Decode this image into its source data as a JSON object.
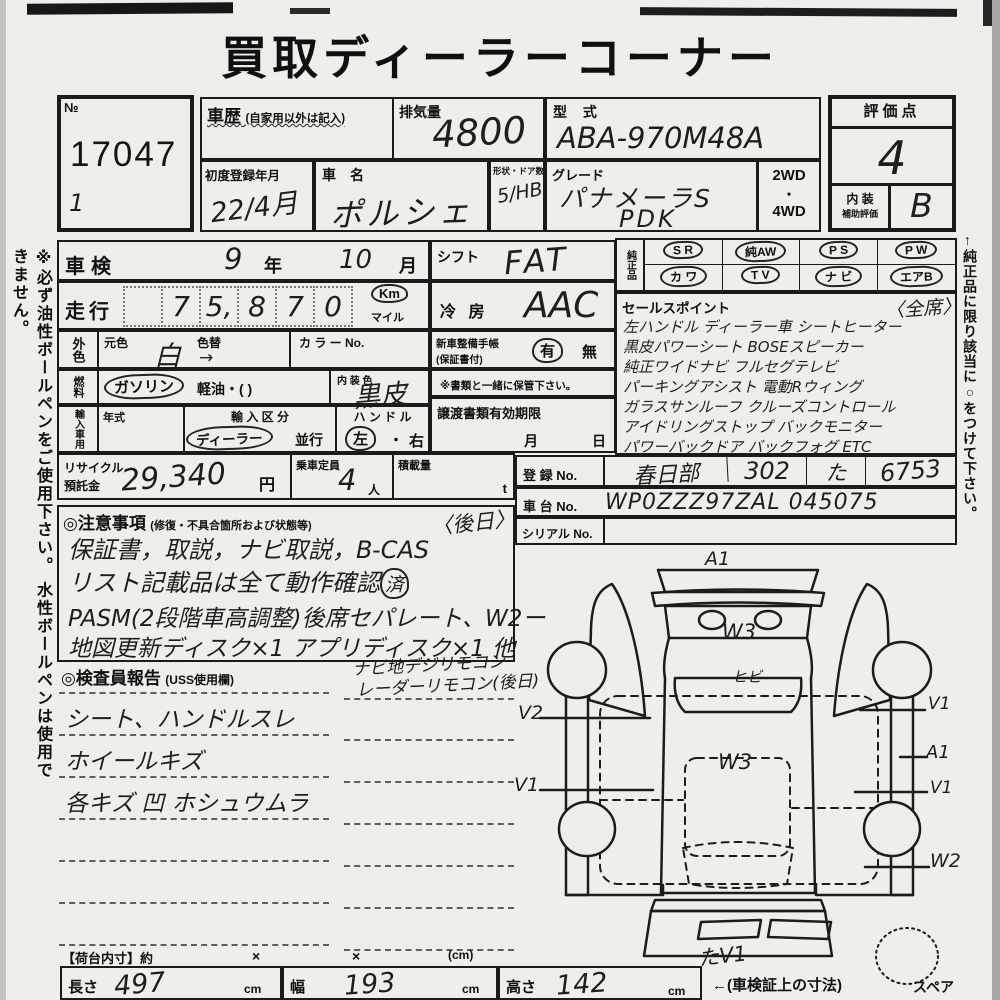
{
  "page": {
    "title": "買取ディーラーコーナー",
    "left_note": "※必ず油性ボールペンをご使用下さい。 水性ボールペンは使用できません。",
    "right_note": "←純正品に限り該当に○をつけて下さい。"
  },
  "header": {
    "no_label": "№",
    "no_value": "17047",
    "no_sub": "1",
    "shareki_label": "車歴",
    "shareki_note": "(自家用以外は記入)",
    "haikiryo_label": "排気量",
    "haikiryo_value": "4800",
    "katashiki_label": "型 式",
    "katashiki_value": "ABA-970M48A",
    "hyokaten_label": "評価点",
    "hyokaten_value": "4",
    "naiso_label_1": "内 装",
    "naiso_label_2": "補助評価",
    "naiso_value": "B",
    "shodo_label": "初度登録年月",
    "shodo_value": "22/4月",
    "shamei_label": "車　名",
    "shamei_value": "ポルシェ",
    "keijo_label": "形状・ドア数",
    "keijo_value": "5/HB",
    "grade_label": "グレード",
    "grade_value_1": "パナメーラS",
    "grade_value_2": "PDK",
    "drive": [
      "2WD",
      "・",
      "4WD"
    ]
  },
  "main": {
    "shaken_label": "車検",
    "shaken_year": "9",
    "shaken_year_unit": "年",
    "shaken_month": "10",
    "shaken_month_unit": "月",
    "soko_label": "走行",
    "soko_digits": [
      "",
      "7",
      "5,",
      "8",
      "7",
      "0"
    ],
    "soko_km": "Km",
    "soko_mile": "マイル",
    "shift_label": "シフト",
    "shift_value": "FAT",
    "reibo_label": "冷 房",
    "reibo_value": "AAC",
    "gaishoku_label": "外色",
    "motoiro_label": "元色",
    "motoiro_value": "白",
    "motoiro_arrow": "→",
    "irogae_label": "色替",
    "color_no_label": "カ ラ ー No.",
    "seibi_label_1": "新車整備手帳",
    "seibi_label_2": "(保証書付)",
    "seibi_yes": "有",
    "seibi_no": "無",
    "hokan_note": "※書類と一緒に保管下さい。",
    "nenryo_label": "燃料",
    "nenryo_gasoline": "ガソリン",
    "nenryo_keiyu": "軽油・(          )",
    "naisoshoku_label": "内 装 色",
    "naisoshoku_value": "黒皮",
    "yunyu_label": "輸入車用",
    "nenshiki_label": "年式",
    "kubun_label": "輸 入 区 分",
    "kubun_dealer": "ディーラー",
    "kubun_heiko": "並行",
    "handle_label": "ハ ン ド ル",
    "handle_left": "左",
    "handle_dot": "・",
    "handle_right": "右",
    "joto_label": "譲渡書類有効期限",
    "joto_month": "月",
    "joto_day": "日",
    "recycle_label_1": "リサイクル",
    "recycle_label_2": "預託金",
    "recycle_value": "29,340",
    "recycle_unit": "円",
    "teiin_label": "乗車定員",
    "teiin_value": "4",
    "teiin_unit": "人",
    "sekisai_label": "積載量",
    "sekisai_unit": "t"
  },
  "junseihin": {
    "label": "純正品",
    "items": [
      "S R",
      "純AW",
      "P S",
      "P W",
      "カ ワ",
      "T V",
      "ナ ビ",
      "エアB"
    ]
  },
  "sales": {
    "label": "セールスポイント",
    "zenseki": "〈全席〉",
    "lines": [
      "左ハンドル ディーラー車 シートヒーター",
      "黒皮パワーシート BOSEスピーカー",
      "純正ワイドナビ フルセグテレビ",
      "パーキングアシスト 電動Rウィング",
      "ガラスサンルーフ クルーズコントロール",
      "アイドリングストップ バックモニター",
      "パワーバックドア バックフォグ ETC"
    ]
  },
  "registration": {
    "toroku_label": "登 録 No.",
    "toroku_area": "春日部",
    "toroku_class": "302",
    "toroku_kana": "た",
    "toroku_number": "6753",
    "shadai_label": "車 台 No.",
    "shadai_value": "WP0ZZZ97ZAL 045075",
    "serial_label": "シリアル No."
  },
  "chui": {
    "label": "◎注意事項",
    "sub": "(修復・不具合箇所および状態等)",
    "gojitsu": "〈後日〉",
    "line1": "保証書，取説，ナビ取説，B-CAS",
    "line2": "リスト記載品は全て動作確認",
    "line2_circled": "済",
    "line3": "PASM(2段階車高調整)後席セパレート、W2ー",
    "line4": "地図更新ディスク×1 アプリディスク×1 他"
  },
  "kensain": {
    "label": "◎検査員報告",
    "sub": "(USS使用欄)",
    "overflow_1": "ナビ地デジリモコン",
    "overflow_2": "レーダーリモコン(後日)",
    "line1": "シート、ハンドルスレ",
    "line2": "ホイールキズ",
    "line3": "各キズ 凹 ホシュウムラ"
  },
  "diagram": {
    "label_top": "A1",
    "label_hood": "W3",
    "label_windshield": "ヒビ",
    "label_roof": "W3",
    "label_left_v2": "V2",
    "label_left_v1": "V1",
    "label_right_v1_top": "V1",
    "label_right_a1": "A1",
    "label_right_v1_mid": "V1",
    "label_right_w2": "W2",
    "label_bottom": "たV1",
    "label_spare": "スペア"
  },
  "footer": {
    "nidai_label": "【荷台内寸】約",
    "times_1": "×",
    "times_2": "×",
    "cm_note": "(cm)",
    "nagasa_label": "長さ",
    "nagasa_value": "497",
    "haba_label": "幅",
    "haba_value": "193",
    "takasa_label": "高さ",
    "takasa_value": "142",
    "cm_unit": "cm",
    "note": "←(車検証上の寸法)"
  }
}
